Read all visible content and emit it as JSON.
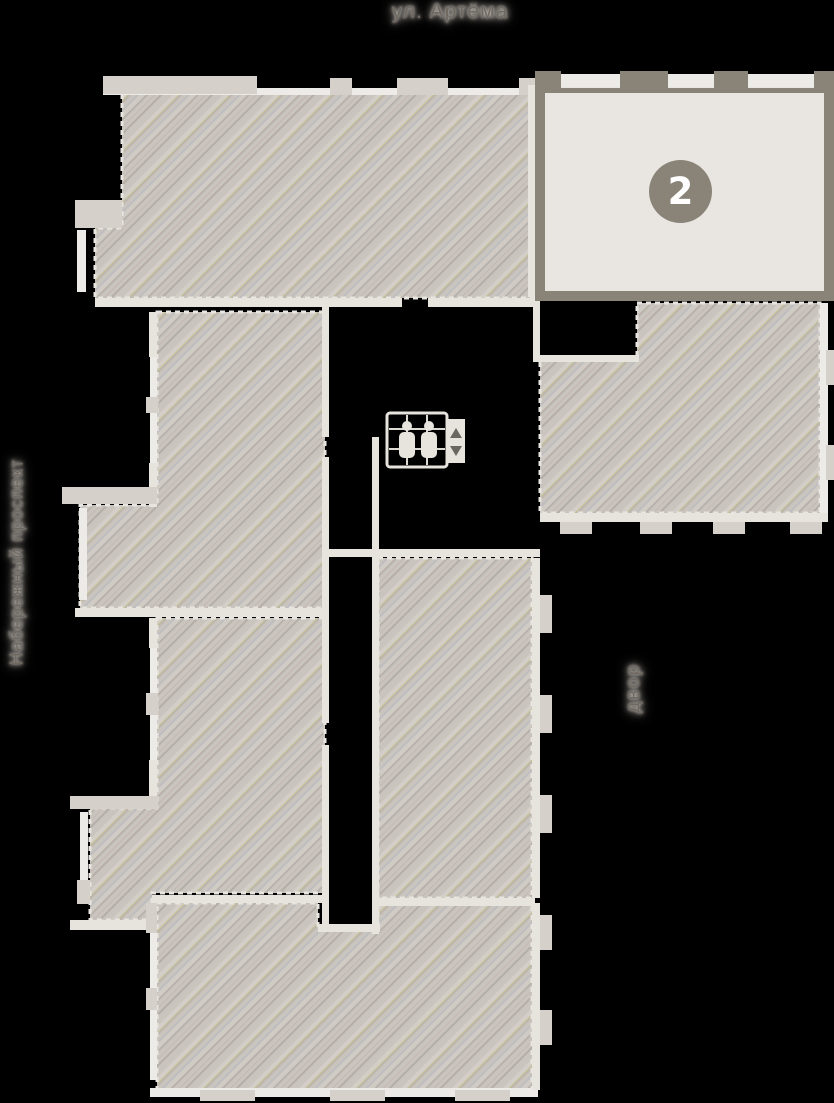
{
  "labels": {
    "street_top": "ул. Артёма",
    "street_left": "Набережный проспект",
    "courtyard": "двор"
  },
  "unit": {
    "number": "2",
    "status": "available-highlighted"
  },
  "icons": {
    "elevator": "elevator-people-icon"
  },
  "colors": {
    "background": "#000000",
    "wall_light": "#e7e4de",
    "wall_pier": "#d5d1ca",
    "hatch_base": "#c9c4bd",
    "hatch_stripe_dark": "#b5afa7",
    "hatch_stripe_light": "#d4cfc8",
    "unit_available_fill": "#e9e6e2",
    "unit_available_border": "#8a8478",
    "badge_bg": "#8a8478",
    "badge_text": "#ffffff",
    "label_text": "#6f6961",
    "label_halo": "#cfcac3"
  }
}
